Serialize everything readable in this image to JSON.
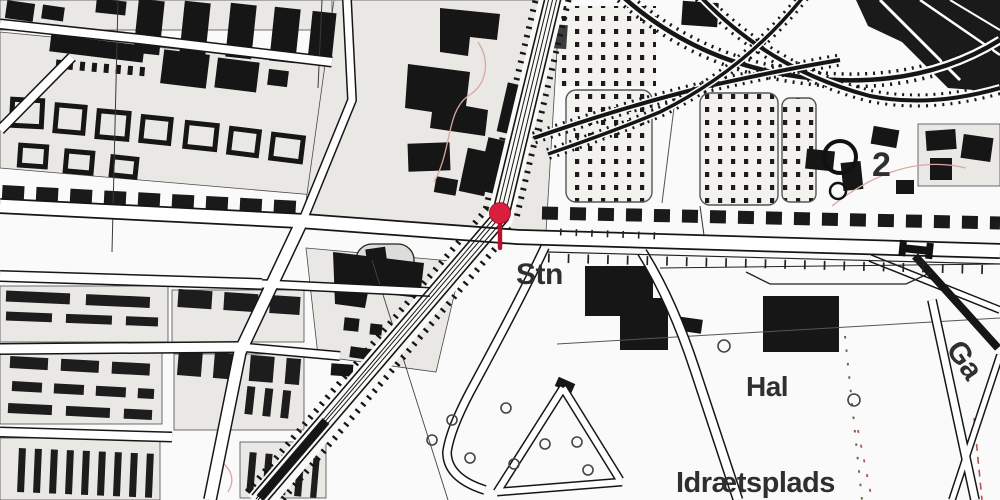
{
  "map": {
    "kind": "danish-topographic-station-map",
    "labels": {
      "station_abbr": "Stn",
      "hall": "Hal",
      "sports_field": "Idrætsplads",
      "spot_number": "2",
      "street_name_partial": "Ga"
    },
    "marker": {
      "name": "station-location-pin",
      "head_color": "#d91f3d",
      "stem_color": "#b8122e",
      "outline_color": "#8f0f26"
    },
    "colors": {
      "paper": "#fbfafa",
      "ink": "#161616",
      "block_fill": "#e9e8e5",
      "label_ink": "#2f2f2f",
      "contour_red": "#d9a8a0",
      "boundary_red": "#b4554f"
    }
  }
}
